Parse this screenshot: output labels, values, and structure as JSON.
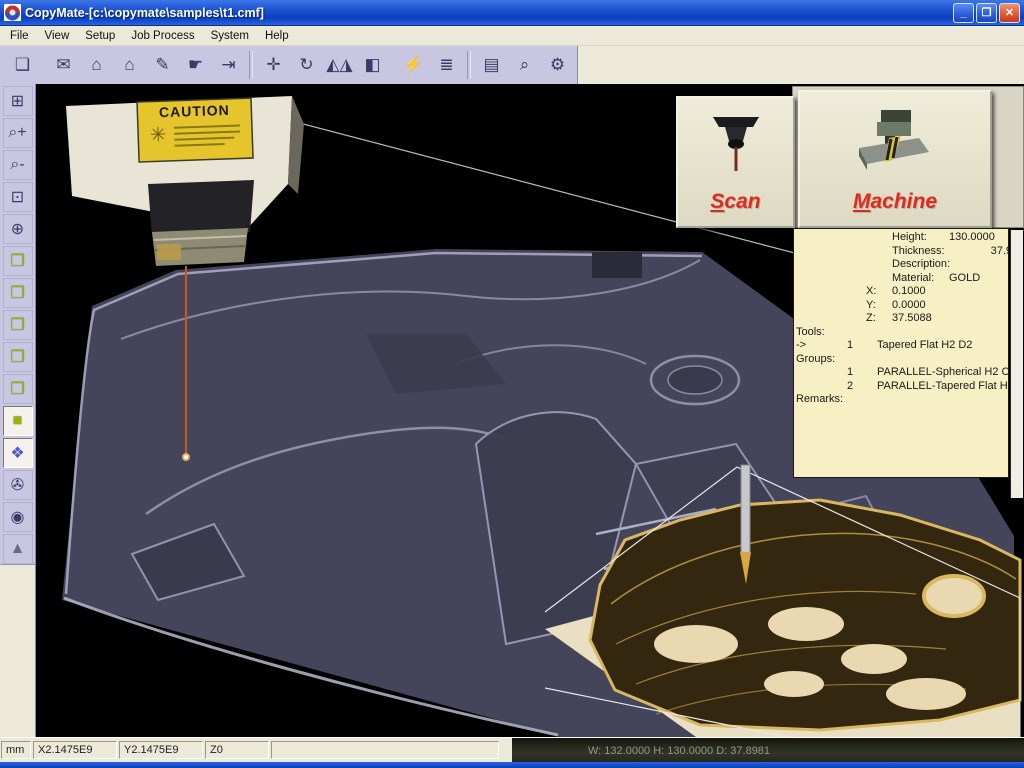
{
  "window": {
    "title": "CopyMate-[c:\\copymate\\samples\\t1.cmf]",
    "controls": {
      "minimize": "_",
      "restore": "❐",
      "close": "✕"
    }
  },
  "menu": {
    "items": [
      {
        "label": "File"
      },
      {
        "label": "View"
      },
      {
        "label": "Setup"
      },
      {
        "label": "Job Process"
      },
      {
        "label": "System"
      },
      {
        "label": "Help"
      }
    ]
  },
  "toolbar": {
    "items": [
      {
        "name": "new-file",
        "glyph": "❏"
      },
      {
        "name": "open-file",
        "glyph": "✉"
      },
      {
        "name": "probe-raise",
        "glyph": "⌂"
      },
      {
        "name": "probe-lower",
        "glyph": "⌂"
      },
      {
        "name": "edit-path",
        "glyph": "✎"
      },
      {
        "name": "pointer-tools",
        "glyph": "☛"
      },
      {
        "name": "exit-door",
        "glyph": "⇥"
      },
      {
        "name": "pan-view",
        "glyph": "✛"
      },
      {
        "name": "rotate-view",
        "glyph": "↻"
      },
      {
        "name": "mirror",
        "glyph": "◭◮"
      },
      {
        "name": "fill-shade",
        "glyph": "◧"
      },
      {
        "name": "machine-connect",
        "glyph": "⚡"
      },
      {
        "name": "layers-book",
        "glyph": "≣"
      },
      {
        "name": "scan-job",
        "glyph": "▤"
      },
      {
        "name": "verify-find",
        "glyph": "⌕"
      },
      {
        "name": "system-settings",
        "glyph": "⚙"
      }
    ]
  },
  "sidebar": {
    "items": [
      {
        "name": "layout-grid",
        "glyph": "⊞"
      },
      {
        "name": "zoom-in",
        "glyph": "⌕+"
      },
      {
        "name": "zoom-out",
        "glyph": "⌕-"
      },
      {
        "name": "zoom-window",
        "glyph": "⊡"
      },
      {
        "name": "rotate-sphere",
        "glyph": "⊕"
      },
      {
        "name": "view-top",
        "glyph": "❒"
      },
      {
        "name": "view-front",
        "glyph": "❒"
      },
      {
        "name": "view-side",
        "glyph": "❒"
      },
      {
        "name": "view-back",
        "glyph": "❒"
      },
      {
        "name": "view-corner",
        "glyph": "❒"
      },
      {
        "name": "view-isometric",
        "glyph": "■"
      },
      {
        "name": "render-shaded",
        "glyph": "❖"
      },
      {
        "name": "camera-record",
        "glyph": "✇"
      },
      {
        "name": "eye-visibility",
        "glyph": "◉"
      },
      {
        "name": "light-source",
        "glyph": "▲"
      }
    ]
  },
  "overlay_buttons": {
    "scan_label": "Scan",
    "machine_label": "Machine"
  },
  "info_panel": {
    "fields": [
      {
        "label": "Height:",
        "value": "130.0000"
      },
      {
        "label": "Thickness:",
        "value": "37.9"
      },
      {
        "label": "Description:",
        "value": ""
      },
      {
        "label": "Material:",
        "value": "GOLD"
      }
    ],
    "coords": [
      {
        "label": "X:",
        "value": "0.1000"
      },
      {
        "label": "Y:",
        "value": "0.0000"
      },
      {
        "label": "Z:",
        "value": "37.5088"
      }
    ],
    "tools_header": "Tools:",
    "tools": [
      {
        "marker": "->",
        "num": "1",
        "name": "Tapered Flat H2 D2"
      }
    ],
    "groups_header": "Groups:",
    "groups": [
      {
        "num": "1",
        "name": "PARALLEL-Spherical H2 C1"
      },
      {
        "num": "2",
        "name": "PARALLEL-Tapered Flat H2"
      }
    ],
    "remarks_header": "Remarks:"
  },
  "canvas": {
    "caution_label": "CAUTION"
  },
  "status_bar": {
    "units": "mm",
    "x": "X2.1475E9",
    "y": "Y2.1475E9",
    "z": "Z0",
    "dims": "W: 132.0000 H: 130.0000 D: 37.8981"
  },
  "colors": {
    "titlebar_blue": "#1d52cf",
    "toolbar_lavender": "#c9c6e2",
    "panel_cream": "#f7f0c4",
    "button_red_text": "#e02a20",
    "laser_orange": "#c05a1e",
    "part_slate": "#44445a",
    "gold": "#d9b85f"
  }
}
